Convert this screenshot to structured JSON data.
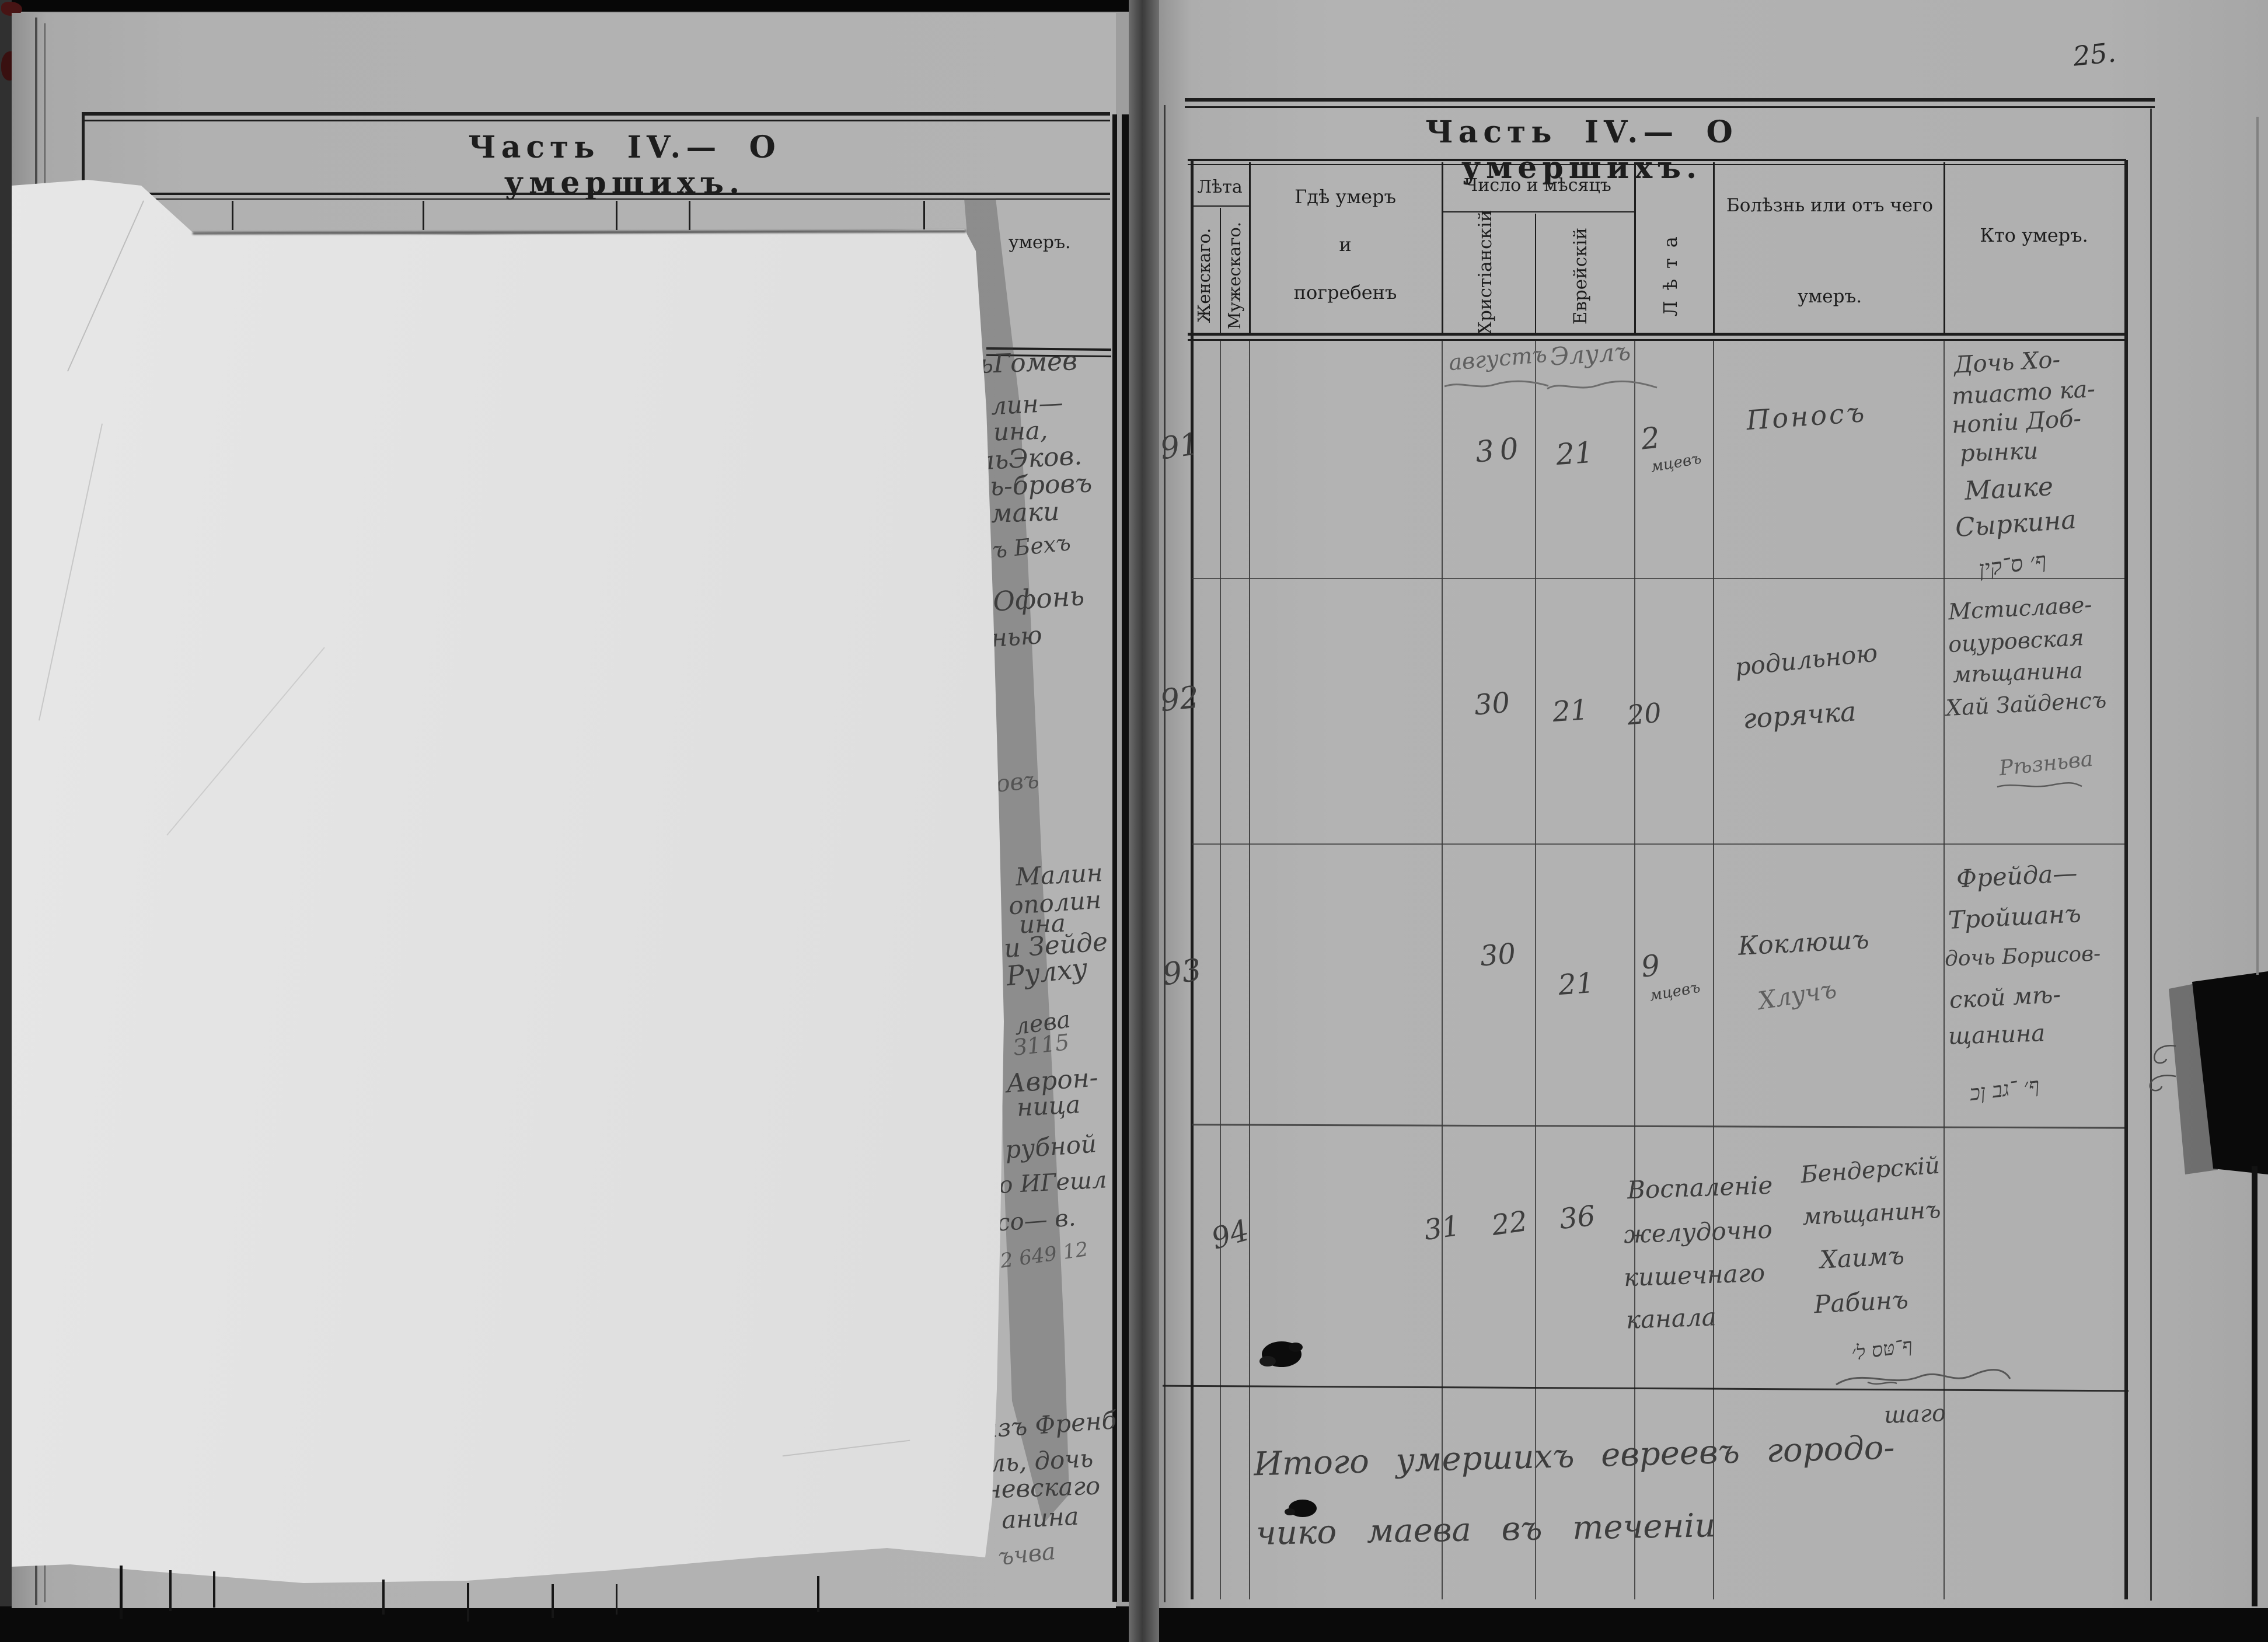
{
  "scan": {
    "page_number": "25."
  },
  "left_page": {
    "title": "Часть IV.— О умершихъ.",
    "header_fragment": "умеръ.",
    "fragments": [
      {
        "text": "ьГомев"
      },
      {
        "text": "лин—"
      },
      {
        "text": "ина,"
      },
      {
        "text": "льЭков."
      },
      {
        "text": "ль-бровъ"
      },
      {
        "text": "маки"
      },
      {
        "text": "тъ Бехъ"
      },
      {
        "text": "ъ Офонь"
      },
      {
        "text": "нью"
      },
      {
        "text": "говъ"
      },
      {
        "text": "Малин"
      },
      {
        "text": "ополин"
      },
      {
        "text": "ина"
      },
      {
        "text": "и Зейде"
      },
      {
        "text": "Рулху"
      },
      {
        "text": "лева"
      },
      {
        "text": "З115"
      },
      {
        "text": "Аврон-"
      },
      {
        "text": "ница"
      },
      {
        "text": "рубной"
      },
      {
        "text": "мо ИГешл"
      },
      {
        "text": "со— в."
      },
      {
        "text": "12 649 12"
      },
      {
        "text": "изъ Френб"
      },
      {
        "text": "ль, дочь"
      },
      {
        "text": "невскаго"
      },
      {
        "text": "анина"
      },
      {
        "text": "ъчва"
      }
    ]
  },
  "right_page": {
    "title": "Часть IV.— О умершихъ.",
    "header": {
      "leta_group": "Лѣта",
      "female": "Женскаго.",
      "male": "Мужескаго.",
      "where_lines": [
        "Гдѣ умеръ",
        "и",
        "погребенъ"
      ],
      "date_group": "Число и мѣсяцъ",
      "christian": "Христіанскій",
      "jewish": "Еврейскій",
      "age_vertical": "Лѣта",
      "disease_lines": [
        "Болѣзнь или отъ чего",
        "умеръ."
      ],
      "who": "Кто умеръ."
    },
    "months": {
      "christian": "августъ",
      "jewish": "Элулъ"
    },
    "rows": [
      {
        "no": "91",
        "christian_day": "30",
        "jewish_day": "21",
        "age": "2",
        "age_unit": "мцевъ",
        "disease": [
          "Поносъ"
        ],
        "who": [
          "Дочь Хо-",
          "тиасто ка-",
          "нопіи Доб-",
          "рынки",
          "Маике",
          "Сыркина"
        ],
        "who_hebrew": "ף׳ ס־קין"
      },
      {
        "no": "92",
        "christian_day": "30",
        "jewish_day": "21",
        "age": "20",
        "age_unit": "",
        "disease": [
          "родильною",
          "горячка"
        ],
        "who": [
          "Мстиславе-",
          "оцуровская",
          "мѣщанина",
          "Хай Зайденсъ"
        ],
        "who_hebrew": "Рѣзньва"
      },
      {
        "no": "93",
        "christian_day": "30",
        "jewish_day": "21",
        "age": "9",
        "age_unit": "мцевъ",
        "disease": [
          "Коклюшъ",
          "Хлучъ"
        ],
        "who": [
          "Фрейда—",
          "Тройшанъ",
          "дочь Борисов-",
          "ской мѣ-",
          "щанина"
        ],
        "who_hebrew": "ף׳ ־גב ןכ"
      },
      {
        "no": "94",
        "christian_day": "31",
        "jewish_day": "22",
        "age": "36",
        "age_unit": "",
        "disease": [
          "Воспаленіе",
          "желудочно",
          "кишечнаго",
          "канала"
        ],
        "who": [
          "Бендерскій",
          "мѣщанинъ",
          "Хаимъ",
          "Рабинъ"
        ],
        "who_hebrew": "ף־טּס ל׳"
      }
    ],
    "continuation": "шаго",
    "summary": [
      "Итого умершихъ евреевъ городо-",
      "чико маева въ теченіи"
    ]
  }
}
